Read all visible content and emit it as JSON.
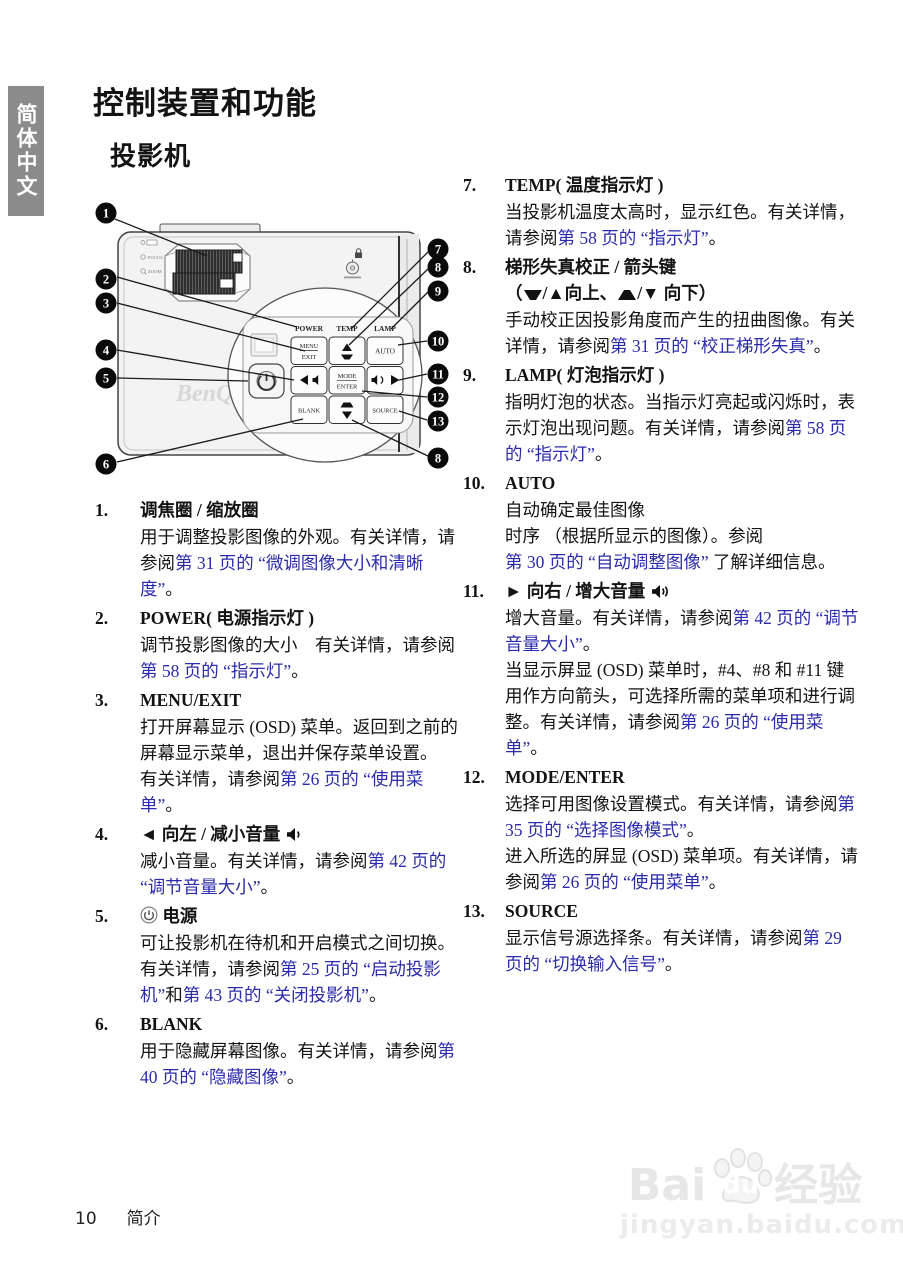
{
  "colors": {
    "link": "#2b2bac",
    "tab_bg": "#8b8b8b"
  },
  "sidebar": {
    "tab_label": "简体中文"
  },
  "header": {
    "page_title": "控制装置和功能",
    "section_title": "投影机"
  },
  "diagram": {
    "brand": "BenQ",
    "labels": {
      "power": "POWER",
      "temp": "TEMP",
      "lamp": "LAMP"
    },
    "buttons": {
      "menu": "MENU",
      "exit": "EXIT",
      "auto": "AUTO",
      "mode": "MODE",
      "enter": "ENTER",
      "blank": "BLANK",
      "source": "SOURCE"
    },
    "side_labels": {
      "focus": "FOCUS",
      "zoom": "ZOOM"
    },
    "callouts": {
      "n1": "1",
      "n2": "2",
      "n3": "3",
      "n4": "4",
      "n5": "5",
      "n6": "6",
      "n7": "7",
      "n8": "8",
      "n9": "9",
      "n10": "10",
      "n11": "11",
      "n12": "12",
      "n13": "13",
      "n8b": "8"
    }
  },
  "items_left": [
    {
      "num": "1.",
      "title": [
        {
          "t": "调焦圈 / 缩放圈"
        }
      ],
      "paras": [
        [
          {
            "t": "用于调整投影图像的外观。有关详情，"
          },
          {
            "t": "请参阅"
          },
          {
            "t": "第 31 页的 “微调图像大小和清晰度”",
            "link": true
          },
          {
            "t": "。"
          }
        ]
      ]
    },
    {
      "num": "2.",
      "title": [
        {
          "t": "POWER( 电源指示灯 )"
        }
      ],
      "paras": [
        [
          {
            "t": "调节投影图像的大小　有关详情，请参阅"
          },
          {
            "t": "第 58 页的 “指示灯”",
            "link": true
          },
          {
            "t": "。"
          }
        ]
      ]
    },
    {
      "num": "3.",
      "title": [
        {
          "t": "MENU/EXIT"
        }
      ],
      "paras": [
        [
          {
            "t": "打开屏幕显示 (OSD) 菜单。返回到之前的屏幕显示菜单，退出并保存菜单设置。"
          }
        ],
        [
          {
            "t": "有关详情，请参阅"
          },
          {
            "t": "第 26 页的 “使用菜单”",
            "link": true
          },
          {
            "t": "。"
          }
        ]
      ]
    },
    {
      "num": "4.",
      "title": [
        {
          "t": "◄ 向左 / 减小音量 "
        },
        {
          "icon": "vol-down"
        }
      ],
      "paras": [
        [
          {
            "t": "减小音量。有关详情，请参阅"
          },
          {
            "t": "第 42 页的 “调节音量大小”",
            "link": true
          },
          {
            "t": "。"
          }
        ]
      ]
    },
    {
      "num": "5.",
      "title": [
        {
          "icon": "power"
        },
        {
          "t": " 电源"
        }
      ],
      "paras": [
        [
          {
            "t": "可让投影机在待机和开启模式之间切换。"
          }
        ],
        [
          {
            "t": "有关详情，请参阅"
          },
          {
            "t": "第 25 页的 “启动投影机”",
            "link": true
          },
          {
            "t": "和"
          },
          {
            "t": "第 43 页的 “关闭投影机”",
            "link": true
          },
          {
            "t": "。"
          }
        ]
      ]
    },
    {
      "num": "6.",
      "title": [
        {
          "t": "BLANK"
        }
      ],
      "paras": [
        [
          {
            "t": "用于隐藏屏幕图像。有关详情，请参阅"
          },
          {
            "t": "第 40 页的 “隐藏图像”",
            "link": true
          },
          {
            "t": "。"
          }
        ]
      ]
    }
  ],
  "items_right": [
    {
      "num": "7.",
      "title": [
        {
          "t": "TEMP( 温度指示灯 )"
        }
      ],
      "paras": [
        [
          {
            "t": "当投影机温度太高时，显示红色。有关详情，请参阅"
          },
          {
            "t": "第 58 页的 “指示灯”",
            "link": true
          },
          {
            "t": "。"
          }
        ]
      ]
    },
    {
      "num": "8.",
      "title": [
        {
          "t": "梯形失真校正 / 箭头键"
        },
        {
          "br": true
        },
        {
          "t": "（"
        },
        {
          "icon": "kt-up"
        },
        {
          "t": "/▲向上、"
        },
        {
          "icon": "kt-down"
        },
        {
          "t": "/▼ 向下）"
        }
      ],
      "paras": [
        [
          {
            "t": "手动校正因投影角度而产生的扭曲图像。有关详情，请参阅"
          },
          {
            "t": "第 31 页的 “校正梯形失真”",
            "link": true
          },
          {
            "t": "。"
          }
        ]
      ]
    },
    {
      "num": "9.",
      "title": [
        {
          "t": "LAMP( 灯泡指示灯 )"
        }
      ],
      "paras": [
        [
          {
            "t": "指明灯泡的状态。当指示灯亮起或闪烁时，表示灯泡出现问题。有关详"
          },
          {
            "t": "情，请参阅"
          },
          {
            "t": "第 58 页的 “指示灯”",
            "link": true
          },
          {
            "t": "。"
          }
        ]
      ]
    },
    {
      "num": "10.",
      "title": [
        {
          "t": "AUTO"
        }
      ],
      "paras": [
        [
          {
            "t": "自动确定最佳图像"
          },
          {
            "br": true
          },
          {
            "t": "时序 （根据所显示的图像）。参阅"
          },
          {
            "br": true
          },
          {
            "t": "第 30 页的 “自动调整图像”",
            "link": true
          },
          {
            "t": " 了解详细信息。"
          }
        ]
      ]
    },
    {
      "num": "11.",
      "title": [
        {
          "t": "► 向右 / 增大音量 "
        },
        {
          "icon": "vol-up"
        }
      ],
      "paras": [
        [
          {
            "t": "增大音量。有关详情，请参阅"
          },
          {
            "t": "第 42 页的 “调节音量大小”",
            "link": true
          },
          {
            "t": "。"
          }
        ],
        [
          {
            "t": "当显示屏显 (OSD) 菜单时，#4、#8 和 #11 键用作方向箭头，可选择所需的菜单项和进行调整。有关详情，请参阅"
          },
          {
            "t": "第 26 页的 “使用菜单”",
            "link": true
          },
          {
            "t": "。"
          }
        ]
      ]
    },
    {
      "num": "12.",
      "title": [
        {
          "t": "MODE/ENTER"
        }
      ],
      "paras": [
        [
          {
            "t": "选择可用图像设置模式。有关详情，请参阅"
          },
          {
            "t": "第 35 页的 “选择图像模式”",
            "link": true
          },
          {
            "t": "。"
          }
        ],
        [
          {
            "t": "进入所选的屏显 (OSD) 菜单项。有关详情，请参阅"
          },
          {
            "t": "第 26 页的 “使用菜单”",
            "link": true
          },
          {
            "t": "。"
          }
        ]
      ]
    },
    {
      "num": "13.",
      "title": [
        {
          "t": "SOURCE"
        }
      ],
      "paras": [
        [
          {
            "t": "显示信号源选择条。有关详情，请参阅"
          },
          {
            "t": "第 29 页的 “切换输入信号”",
            "link": true
          },
          {
            "t": "。"
          }
        ]
      ]
    }
  ],
  "footer": {
    "page_number": "10",
    "section_label": "简介"
  },
  "watermark": {
    "brand_a": "Bai",
    "brand_b": "du",
    "brand_c": "经验",
    "url": "jingyan.baidu.com"
  }
}
